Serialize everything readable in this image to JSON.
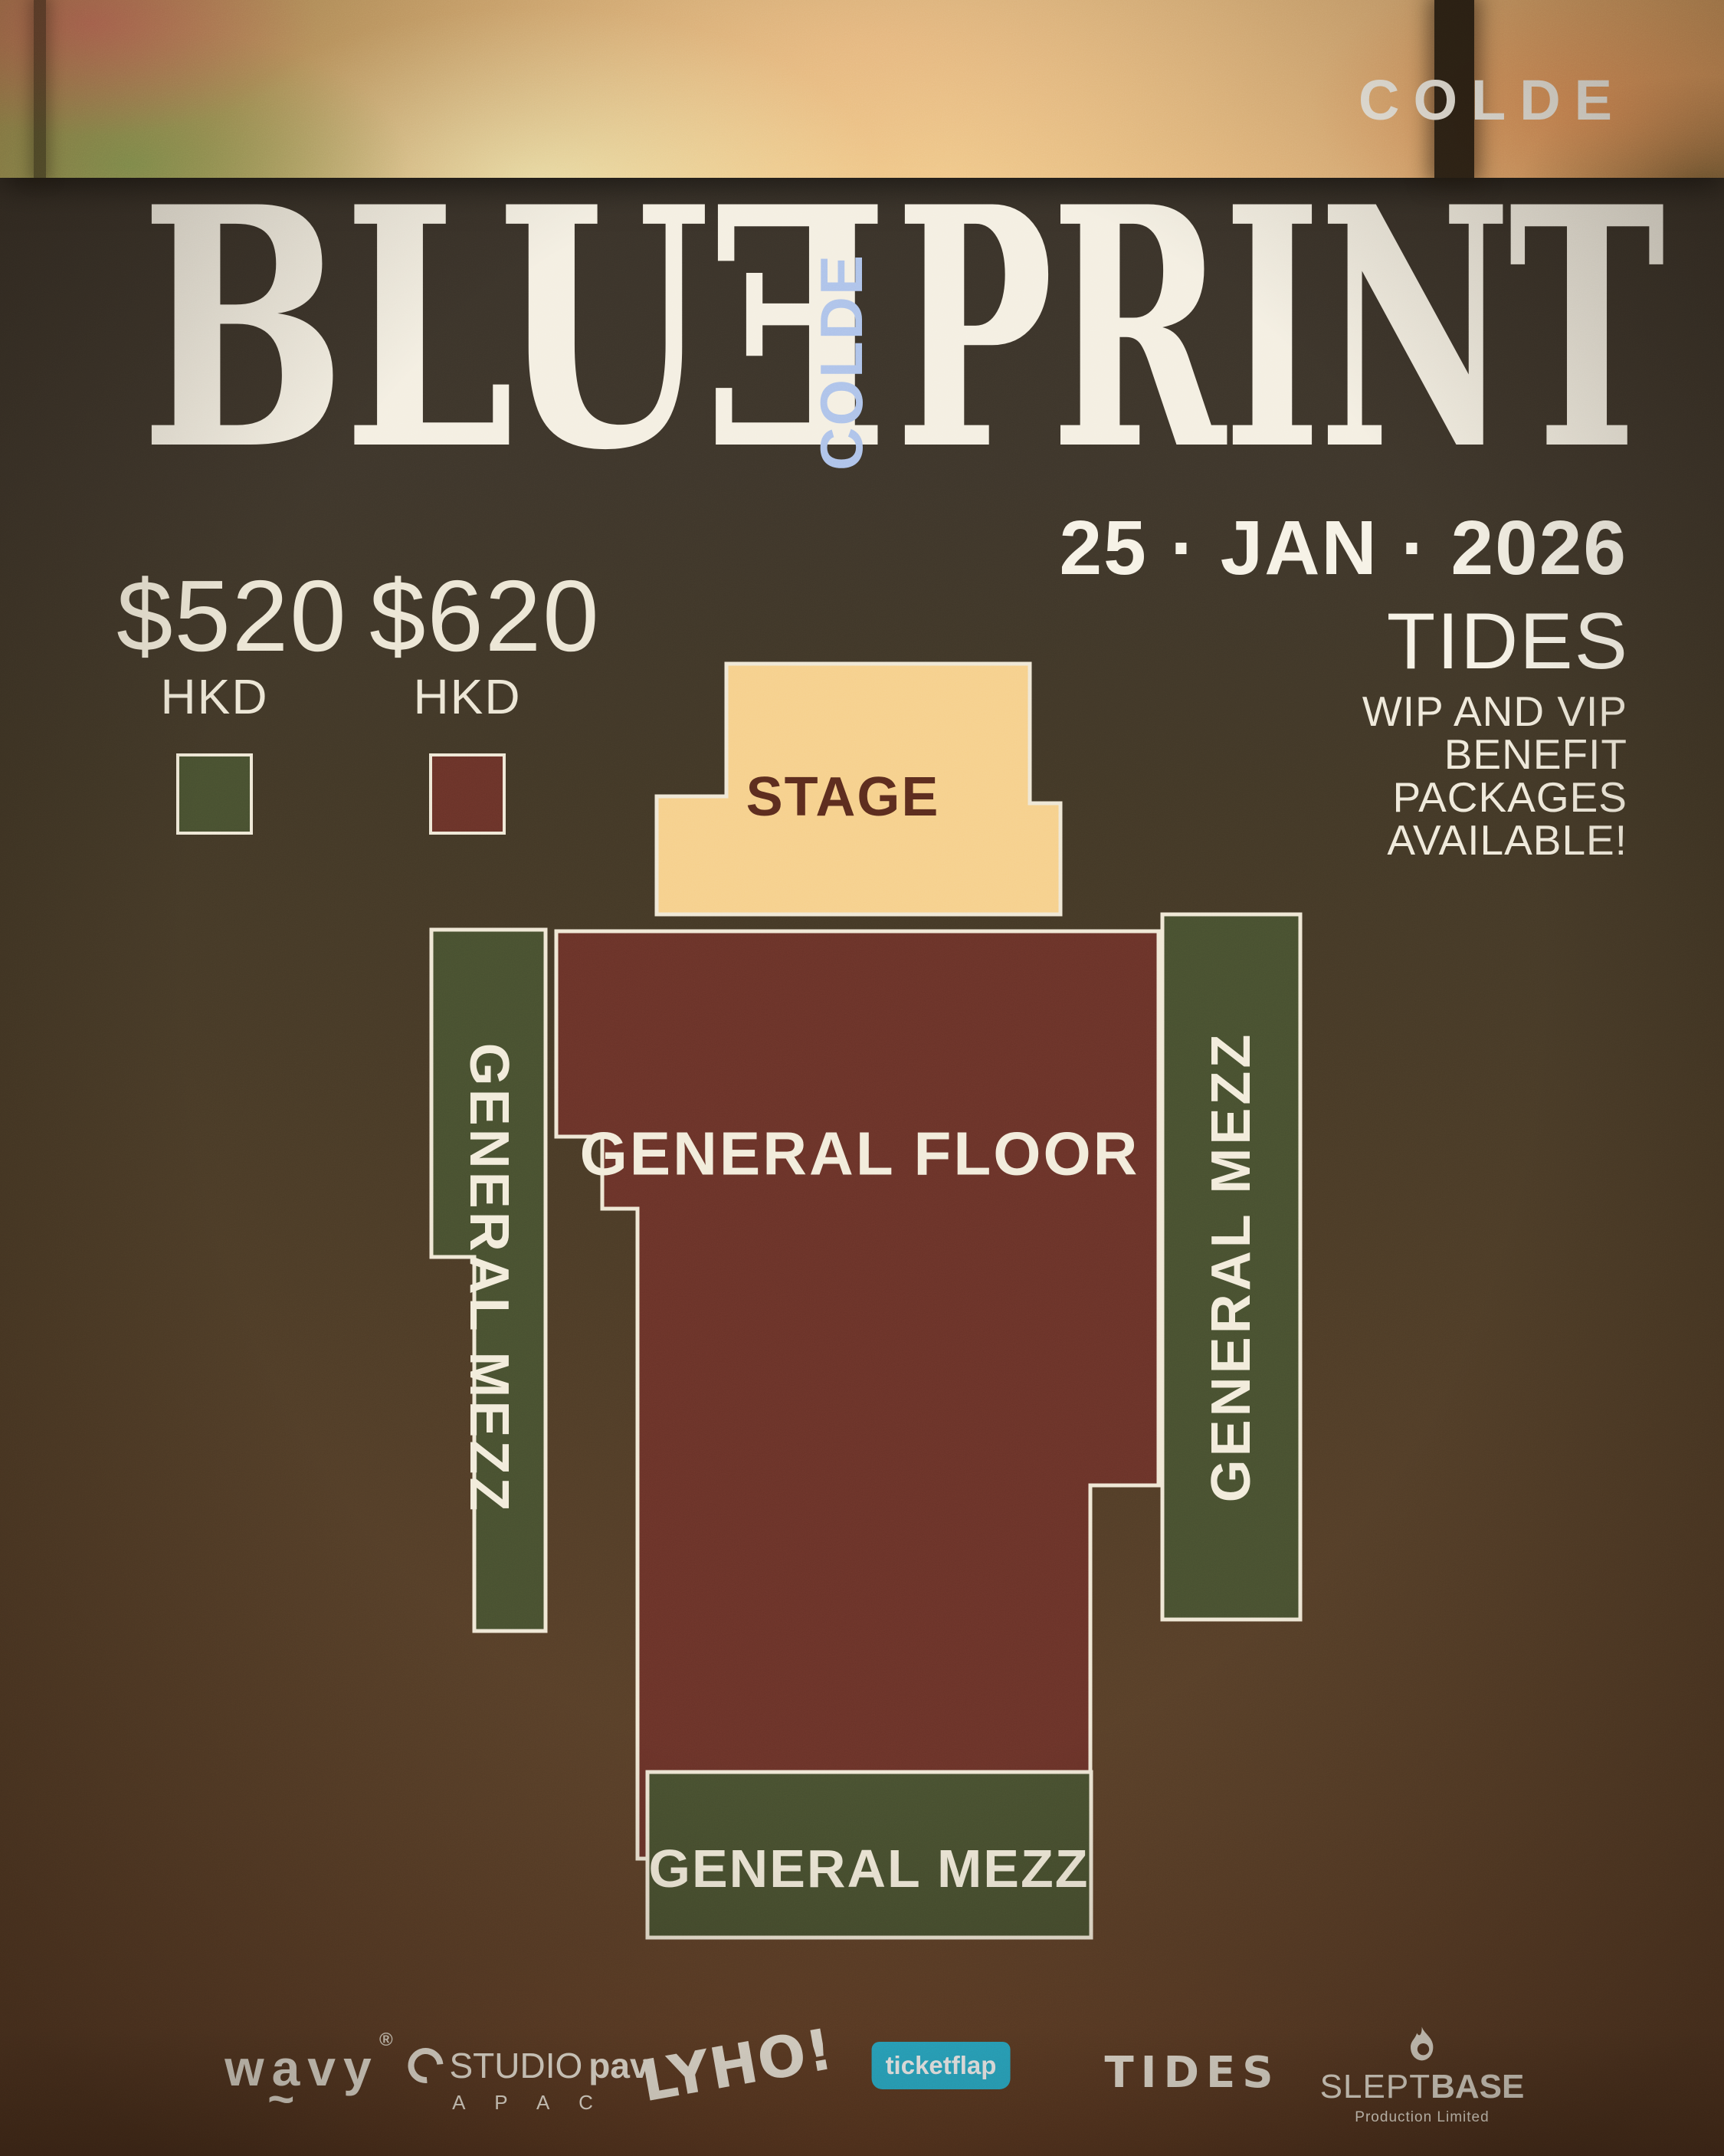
{
  "poster": {
    "artist": "COLDE",
    "title": {
      "word1_main": "BLU",
      "word1_flipped_letter": "E",
      "vertical_label": "COLDE",
      "word2": "PRINT",
      "vertical_label_color": "#aec3ea"
    },
    "date": "25 · JAN · 2026",
    "venue": "TIDES",
    "note_lines": [
      "WIP AND VIP",
      "BENEFIT",
      "PACKAGES",
      "AVAILABLE!"
    ]
  },
  "pricing": {
    "tiers": [
      {
        "price": "$520",
        "currency": "HKD",
        "swatch_color": "#485030"
      },
      {
        "price": "$620",
        "currency": "HKD",
        "swatch_color": "#6a3329"
      }
    ],
    "swatch_border": "#efe8d6"
  },
  "map": {
    "outline_color": "#efe7d5",
    "regions": {
      "stage": {
        "label": "STAGE",
        "fill": "#f6d08c",
        "label_color": "#5b2c1e"
      },
      "floor": {
        "label": "GENERAL FLOOR",
        "fill": "#6a3329"
      },
      "mezz_left": {
        "label": "GENERAL MEZZ",
        "fill": "#485030"
      },
      "mezz_right": {
        "label": "GENERAL MEZZ",
        "fill": "#485030"
      },
      "mezz_bottom": {
        "label": "GENERAL MEZZ",
        "fill": "#485030"
      }
    }
  },
  "footer": {
    "logos": {
      "wavy": {
        "text": "wavy",
        "mark": "®",
        "tilde": "~"
      },
      "studiopav": {
        "prefix": "STUDIO",
        "bold": "pav",
        "sub": "A P A C"
      },
      "lyho": {
        "text": "LYHO!"
      },
      "ticketflap": {
        "text": "ticketflap",
        "badge_color": "#2ab5d3"
      },
      "tides": {
        "text": "TIDES"
      },
      "sleptbase": {
        "light": "SLEPT",
        "bold": "BASE",
        "sub": "Production Limited"
      }
    }
  }
}
